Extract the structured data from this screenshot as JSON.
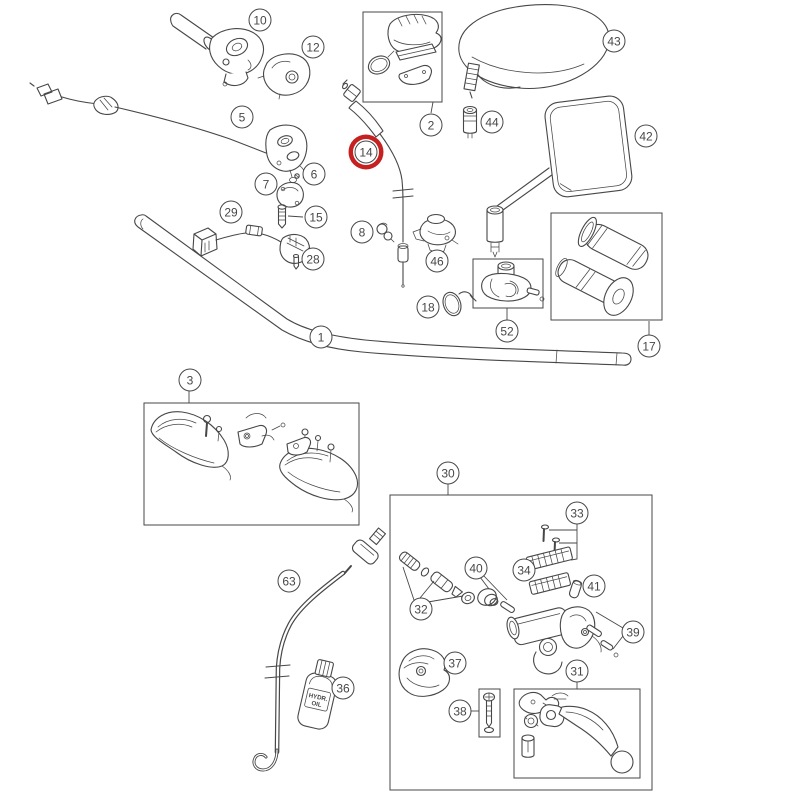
{
  "diagram": {
    "description": "Exploded parts diagram of a motorcycle handlebar assembly",
    "background": "#ffffff",
    "line_color": "#474747",
    "highlight_color": "#c62121",
    "highlighted_callout": "14",
    "oil_bottle_label": {
      "line1": "HYDR.",
      "line2": "OIL"
    },
    "callouts": [
      {
        "label": "10",
        "x": 260,
        "y": 20,
        "highlighted": false
      },
      {
        "label": "12",
        "x": 313,
        "y": 47,
        "highlighted": false
      },
      {
        "label": "2",
        "x": 431,
        "y": 125,
        "highlighted": false
      },
      {
        "label": "43",
        "x": 614,
        "y": 41,
        "highlighted": false
      },
      {
        "label": "44",
        "x": 492,
        "y": 122,
        "highlighted": false
      },
      {
        "label": "42",
        "x": 646,
        "y": 136,
        "highlighted": false
      },
      {
        "label": "5",
        "x": 242,
        "y": 117,
        "highlighted": false
      },
      {
        "label": "14",
        "x": 366,
        "y": 152,
        "highlighted": true
      },
      {
        "label": "7",
        "x": 266,
        "y": 184,
        "highlighted": false
      },
      {
        "label": "6",
        "x": 314,
        "y": 174,
        "highlighted": false
      },
      {
        "label": "15",
        "x": 316,
        "y": 217,
        "highlighted": false
      },
      {
        "label": "8",
        "x": 362,
        "y": 232,
        "highlighted": false
      },
      {
        "label": "29",
        "x": 231,
        "y": 212,
        "highlighted": false
      },
      {
        "label": "28",
        "x": 313,
        "y": 259,
        "highlighted": false
      },
      {
        "label": "46",
        "x": 437,
        "y": 261,
        "highlighted": false
      },
      {
        "label": "18",
        "x": 428,
        "y": 307,
        "highlighted": false
      },
      {
        "label": "52",
        "x": 507,
        "y": 331,
        "highlighted": false
      },
      {
        "label": "17",
        "x": 649,
        "y": 346,
        "highlighted": false
      },
      {
        "label": "1",
        "x": 321,
        "y": 337,
        "highlighted": false
      },
      {
        "label": "3",
        "x": 190,
        "y": 380,
        "highlighted": false
      },
      {
        "label": "30",
        "x": 448,
        "y": 473,
        "highlighted": false
      },
      {
        "label": "33",
        "x": 577,
        "y": 513,
        "highlighted": false
      },
      {
        "label": "40",
        "x": 476,
        "y": 568,
        "highlighted": false
      },
      {
        "label": "34",
        "x": 524,
        "y": 570,
        "highlighted": false
      },
      {
        "label": "41",
        "x": 594,
        "y": 586,
        "highlighted": false
      },
      {
        "label": "32",
        "x": 421,
        "y": 609,
        "highlighted": false
      },
      {
        "label": "39",
        "x": 633,
        "y": 632,
        "highlighted": false
      },
      {
        "label": "63",
        "x": 289,
        "y": 581,
        "highlighted": false
      },
      {
        "label": "37",
        "x": 455,
        "y": 663,
        "highlighted": false
      },
      {
        "label": "36",
        "x": 343,
        "y": 688,
        "highlighted": false
      },
      {
        "label": "38",
        "x": 460,
        "y": 711,
        "highlighted": false
      },
      {
        "label": "31",
        "x": 577,
        "y": 671,
        "highlighted": false
      }
    ]
  }
}
